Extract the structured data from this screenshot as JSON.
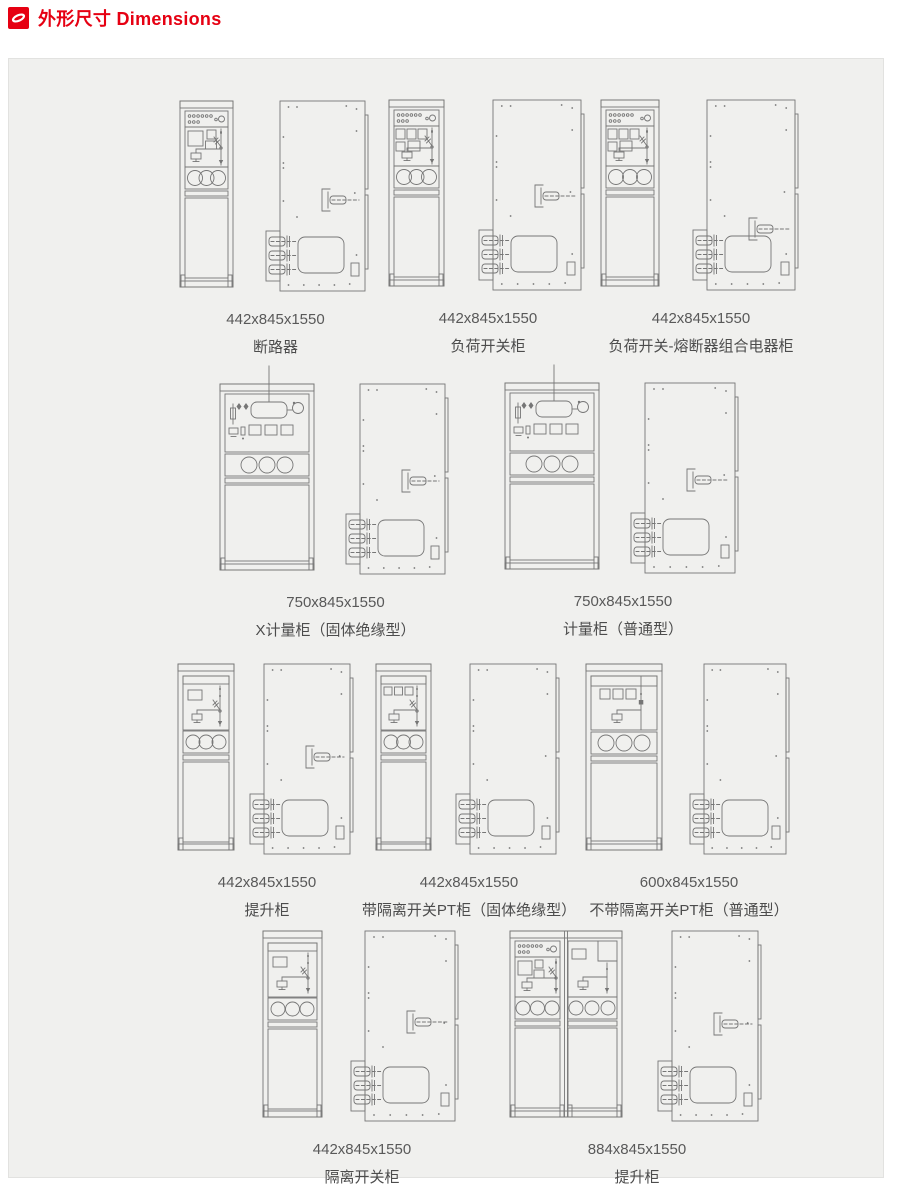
{
  "header": {
    "title": "外形尺寸 Dimensions",
    "accent_color": "#e60012",
    "icon": "brand-s-logo"
  },
  "units": [
    {
      "dims": "442x845x1550",
      "name": "断路器"
    },
    {
      "dims": "442x845x1550",
      "name": "负荷开关柜"
    },
    {
      "dims": "442x845x1550",
      "name": "负荷开关-熔断器组合电器柜"
    },
    {
      "dims": "750x845x1550",
      "name": "X计量柜（固体绝缘型）"
    },
    {
      "dims": "750x845x1550",
      "name": "计量柜（普通型）"
    },
    {
      "dims": "442x845x1550",
      "name": "提升柜"
    },
    {
      "dims": "442x845x1550",
      "name": "带隔离开关PT柜（固体绝缘型）"
    },
    {
      "dims": "600x845x1550",
      "name": "不带隔离开关PT柜（普通型）"
    },
    {
      "dims": "442x845x1550",
      "name": "隔离开关柜"
    },
    {
      "dims": "884x845x1550",
      "name": "提升柜"
    }
  ]
}
